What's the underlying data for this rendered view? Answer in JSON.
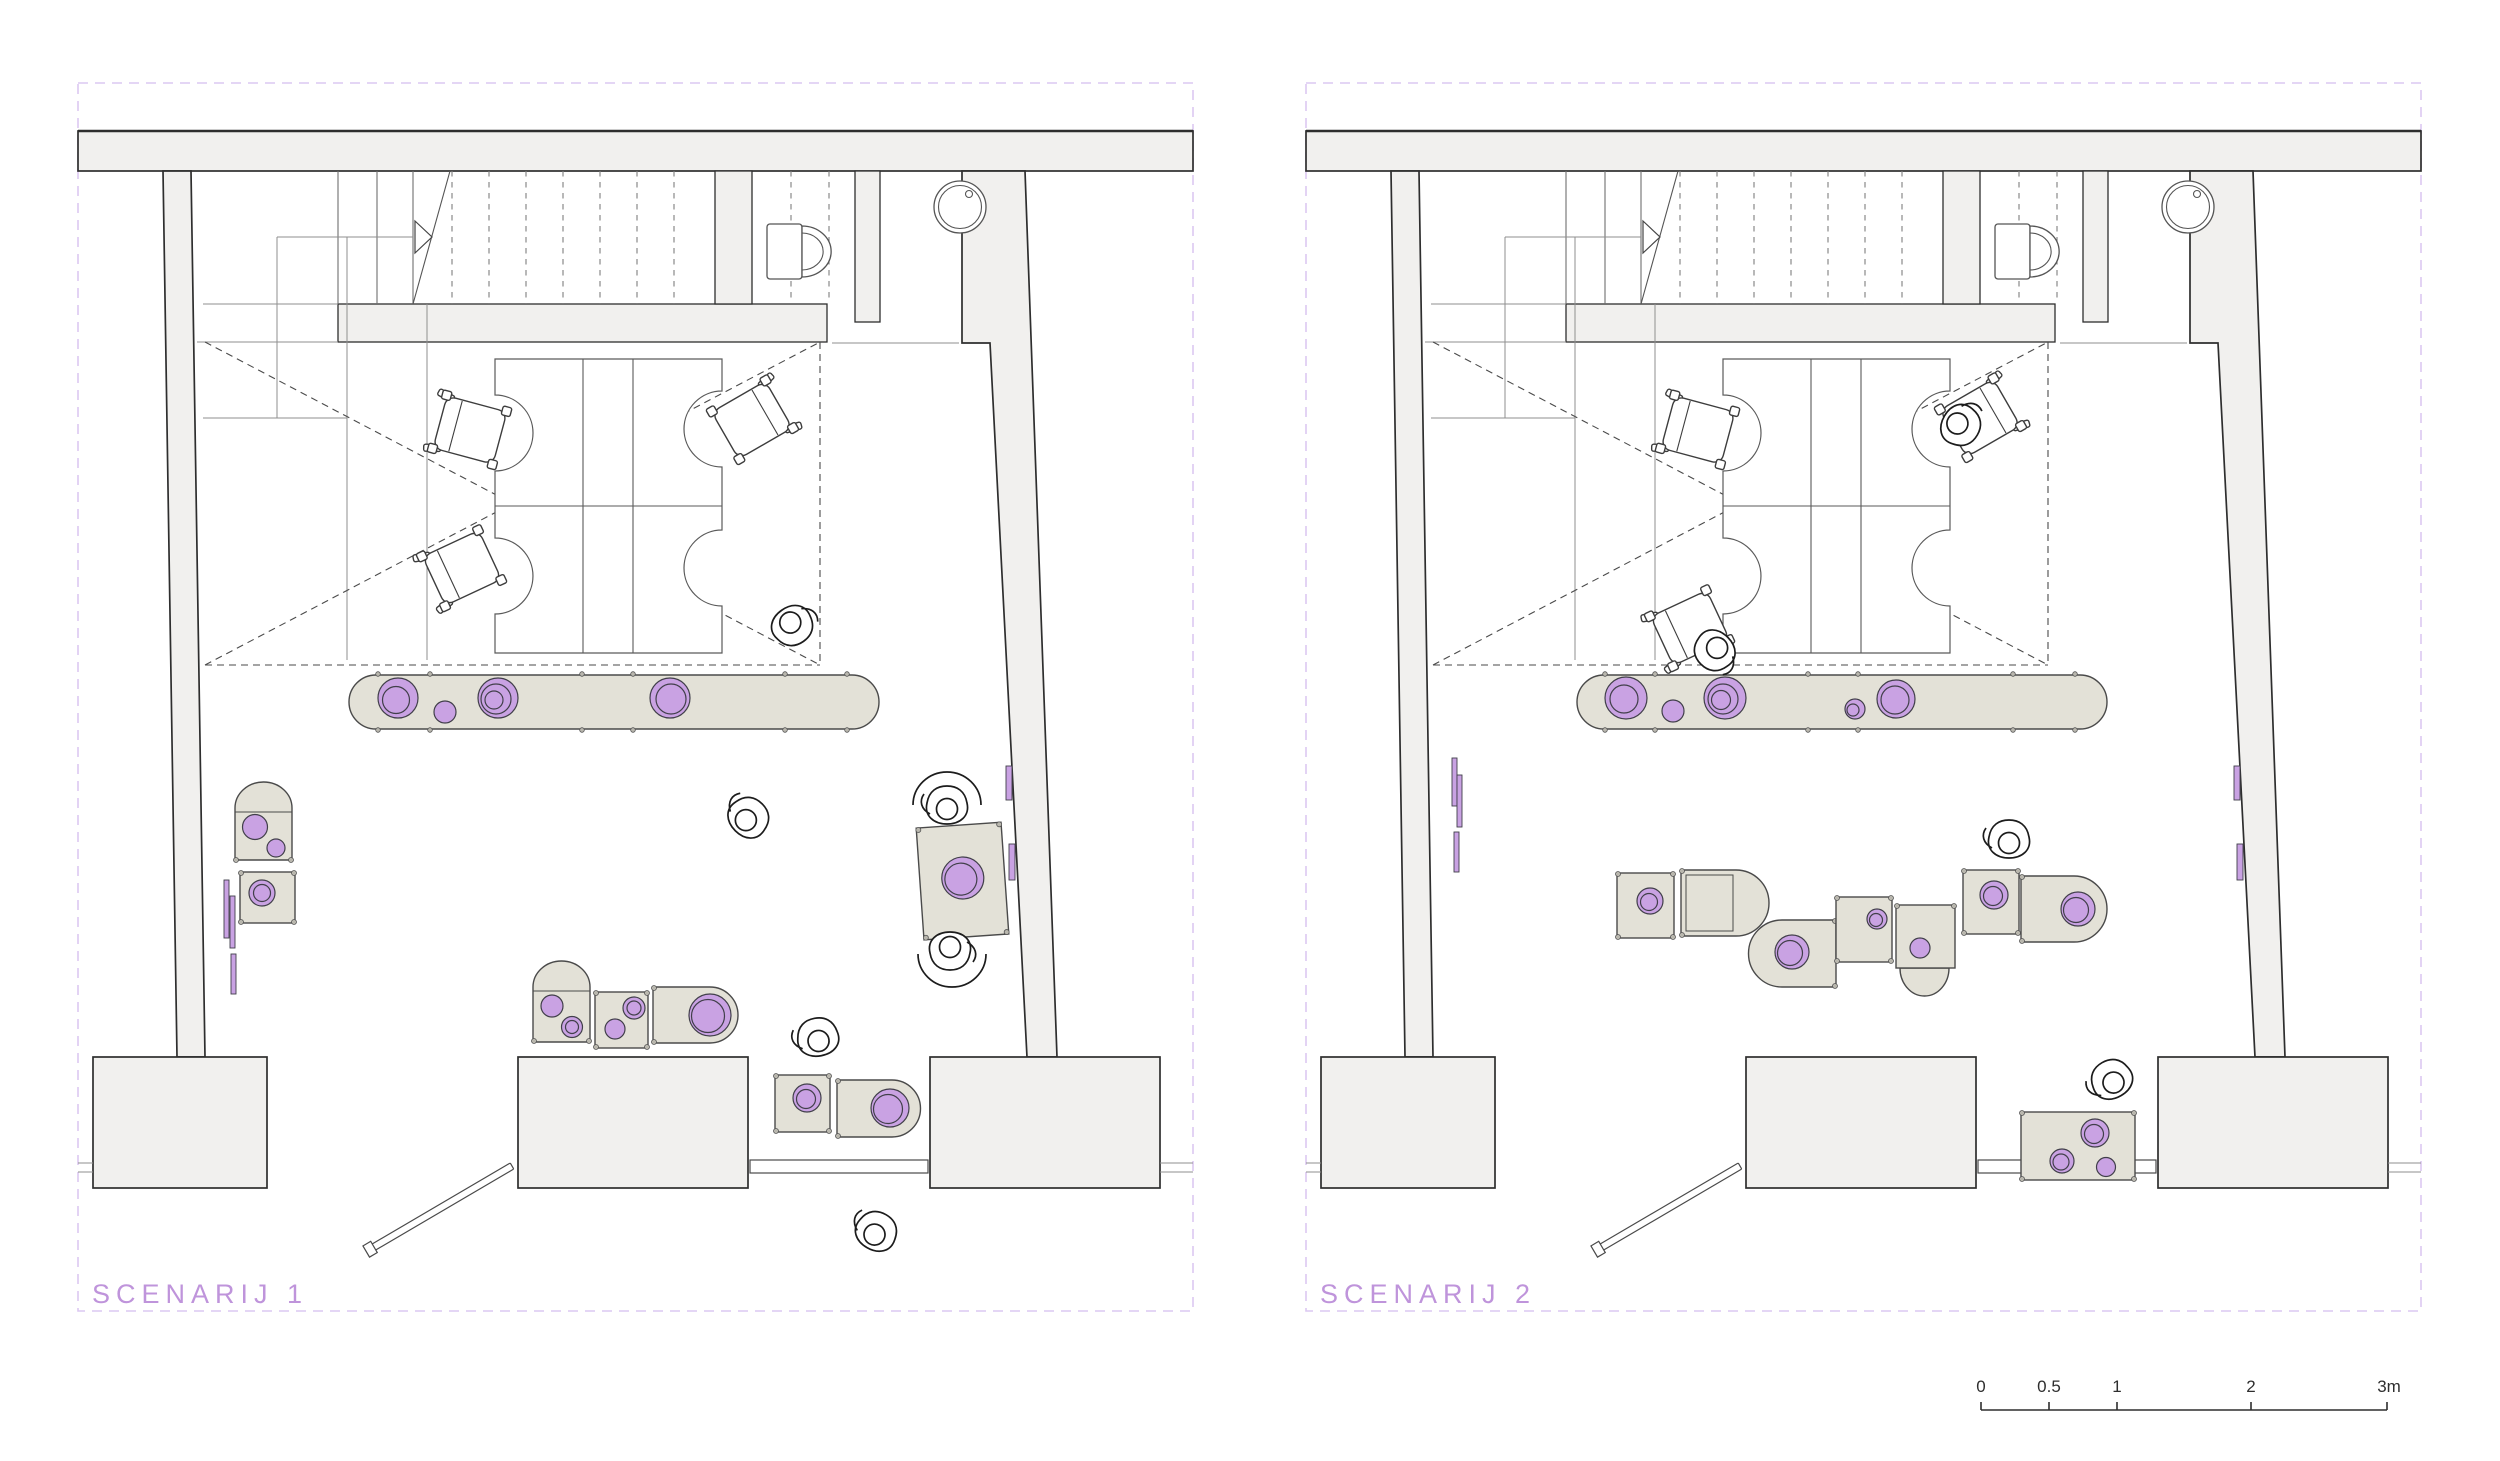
{
  "colors": {
    "accent": "#bf94db",
    "border-dash": "#dcc8f2",
    "wall-fill": "#f1f0ee",
    "line-dark": "#2e2e2e",
    "line-mid": "#5a5a5a",
    "line-thin": "#8f8f8f",
    "mat-fill": "#e3e1d7",
    "mat-stroke": "#4a4a4a",
    "purple": "#c9a2e3",
    "purple-stroke": "#413f4a",
    "scalebar": "#2e2e2e",
    "white": "#ffffff"
  },
  "scenarios": [
    {
      "title": "SCENARIJ 1",
      "elements": {
        "desks": 4,
        "office_chairs": 3,
        "people": 6,
        "bench_cushions": 4,
        "play_mats": 8,
        "wall_panels": 5,
        "toilet": 1,
        "sink": 1,
        "door": 1,
        "staircase": 1
      }
    },
    {
      "title": "SCENARIJ 2",
      "elements": {
        "desks": 4,
        "office_chairs": 3,
        "people": 4,
        "bench_cushions": 5,
        "play_mats": 8,
        "wall_panels": 5,
        "toilet": 1,
        "sink": 1,
        "door": 1,
        "staircase": 1
      }
    }
  ],
  "scale_bar": {
    "labels": [
      "0",
      "0.5",
      "1",
      "2",
      "3m"
    ]
  }
}
